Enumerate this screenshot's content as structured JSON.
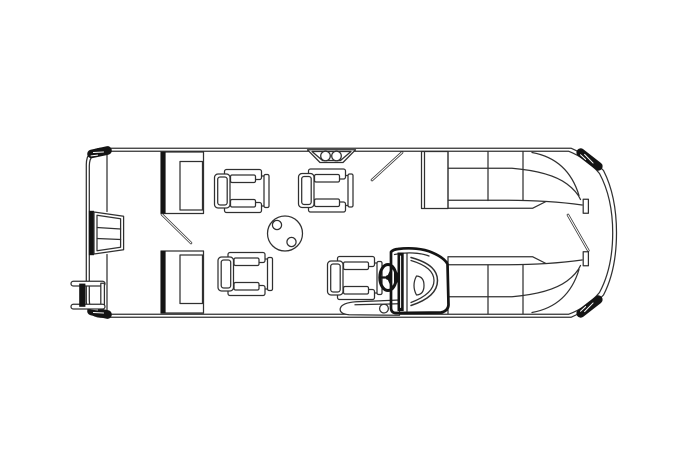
{
  "canvas": {
    "width": 699,
    "height": 466,
    "background": "#ffffff"
  },
  "colors": {
    "line": "#303030",
    "dark_fill": "#141414",
    "background": "#ffffff"
  },
  "diagram": {
    "type": "pontoon-boat-floor-plan",
    "view": "top-down-line-drawing",
    "components": [
      {
        "name": "hull",
        "count": 1
      },
      {
        "name": "deck-rail",
        "count": 1
      },
      {
        "name": "corner-bumper",
        "count": 4
      },
      {
        "name": "bow-boarding-gate",
        "count": 1
      },
      {
        "name": "boarding-ladder",
        "count": 1
      },
      {
        "name": "bench-seat",
        "count": 2
      },
      {
        "name": "captain-chair",
        "count": 4
      },
      {
        "name": "pedestal-table",
        "count": 1,
        "cupholders": 2
      },
      {
        "name": "entry-step",
        "count": 1,
        "cupholders": 2
      },
      {
        "name": "gate-opening",
        "count": 3
      },
      {
        "name": "helm-console",
        "count": 1
      },
      {
        "name": "steering-wheel",
        "count": 1
      },
      {
        "name": "helm-step",
        "count": 1,
        "cupholders": 1
      },
      {
        "name": "stern-wraparound-lounge",
        "count": 2
      },
      {
        "name": "stern-gate-post",
        "count": 2
      }
    ]
  }
}
